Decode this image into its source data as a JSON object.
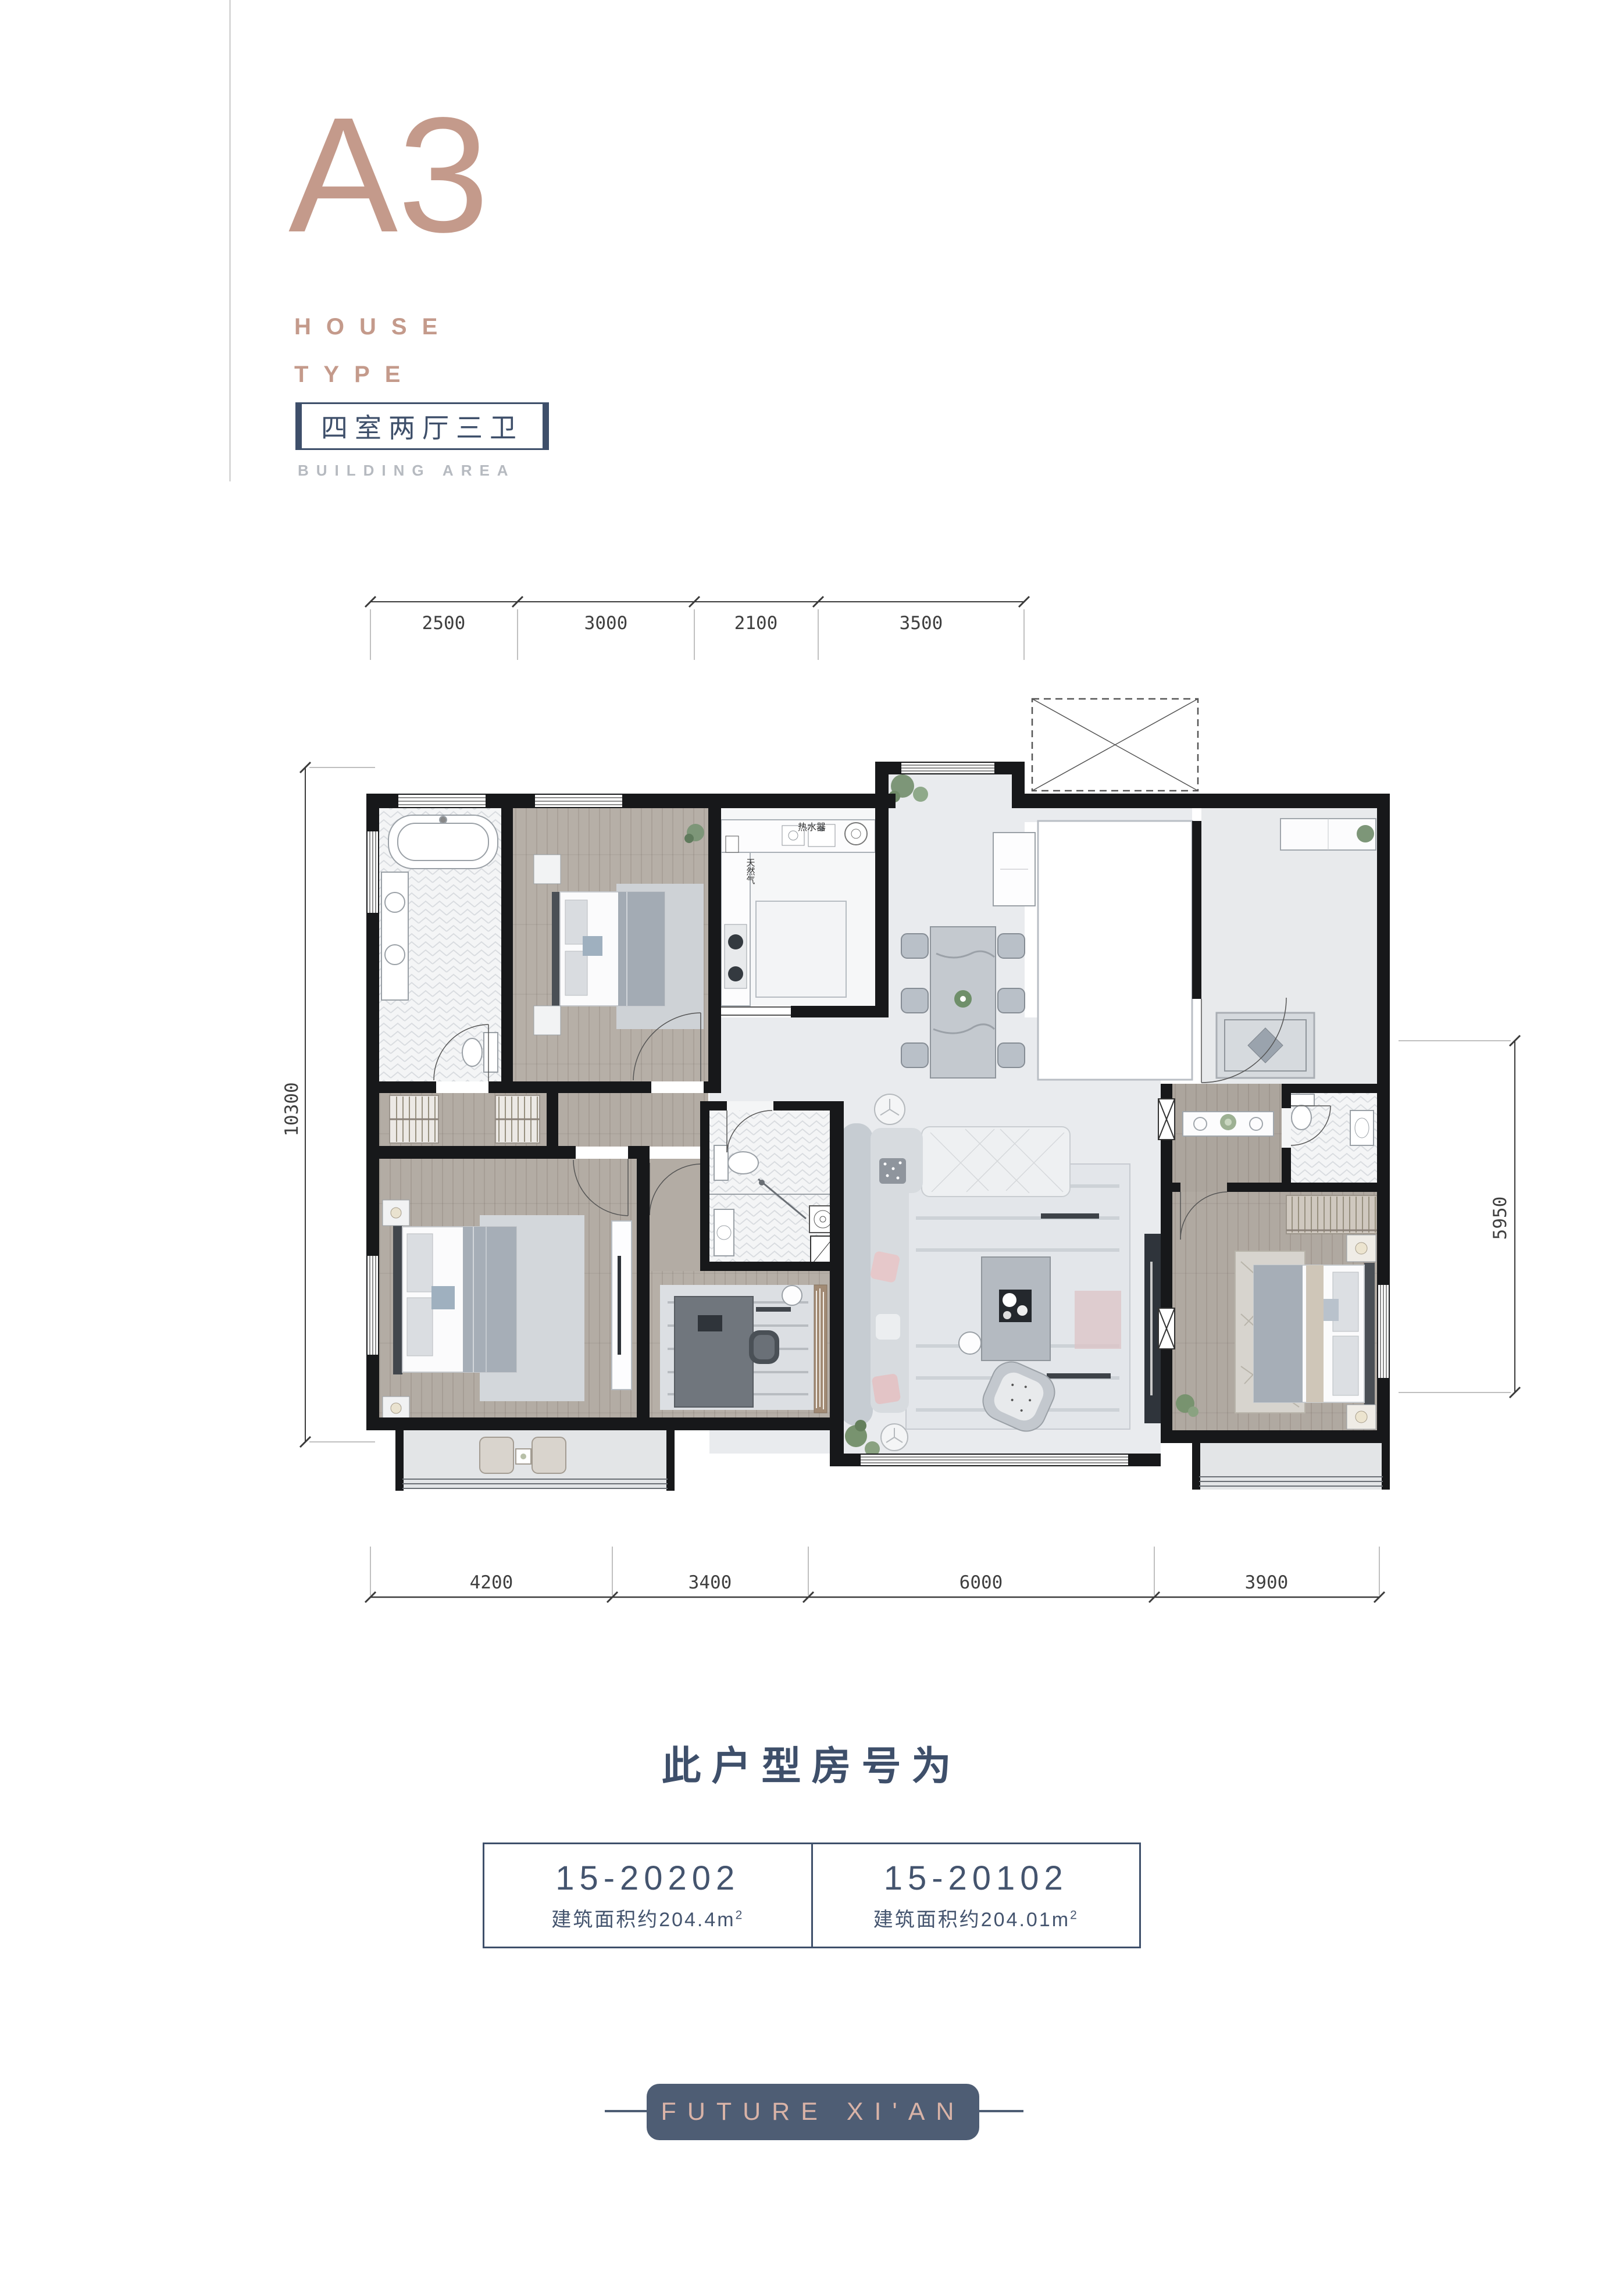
{
  "header": {
    "type_code": "A3",
    "house_line1": "HOUSE",
    "house_line2": "TYPE",
    "badge": "四室两厅三卫",
    "building_area": "BUILDING AREA",
    "accent_color": "#c49a8b",
    "slate_color": "#3e4f6a"
  },
  "floor_plan": {
    "dimensions": {
      "top": [
        "2500",
        "3000",
        "2100",
        "3500"
      ],
      "bottom": [
        "4200",
        "3400",
        "6000",
        "3900"
      ],
      "left": "10300",
      "right": "5950"
    },
    "annotations": {
      "water_heater": "热水器",
      "natural_gas": "天然气"
    }
  },
  "room_info": {
    "title": "此户型房号为",
    "units": [
      {
        "room_no": "15-20202",
        "area_text": "建筑面积约204.4m",
        "area_sup": "2"
      },
      {
        "room_no": "15-20102",
        "area_text": "建筑面积约204.01m",
        "area_sup": "2"
      }
    ]
  },
  "footer": {
    "logo_text": "FUTURE XI'AN"
  }
}
